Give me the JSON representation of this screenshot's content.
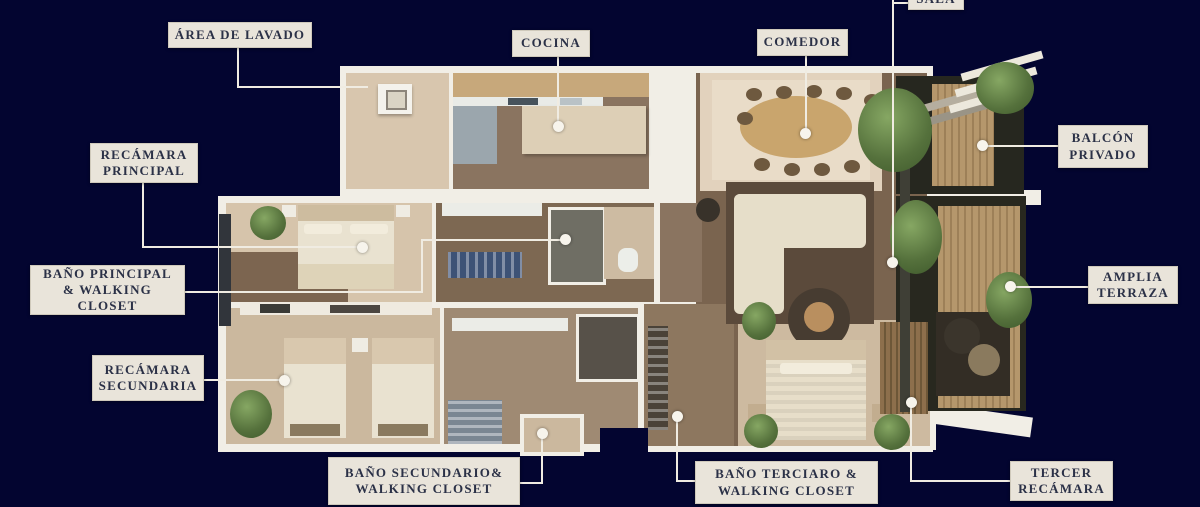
{
  "page": {
    "type": "floor-plan-diagram",
    "background_color": "#030530",
    "label_background": "#e9e4da",
    "label_text_color": "#2b3147",
    "leader_line_color": "#f0ece2"
  },
  "labels": [
    {
      "id": "area-de-lavado",
      "text": "ÁREA DE LAVADO"
    },
    {
      "id": "cocina",
      "text": "COCINA"
    },
    {
      "id": "comedor",
      "text": "COMEDOR"
    },
    {
      "id": "sala",
      "text": "SALA"
    },
    {
      "id": "balcon-privado",
      "text": "BALCÓN\nPRIVADO"
    },
    {
      "id": "recamara-principal",
      "text": "RECÁMARA\nPRINCIPAL"
    },
    {
      "id": "bano-principal",
      "text": "BAÑO PRINCIPAL\n& WALKING\nCLOSET"
    },
    {
      "id": "recamara-secundaria",
      "text": "RECÁMARA\nSECUNDARIA"
    },
    {
      "id": "bano-secundario",
      "text": "BAÑO SECUNDARIO&\nWALKING CLOSET"
    },
    {
      "id": "bano-terciario",
      "text": "BAÑO TERCIARO &\nWALKING CLOSET"
    },
    {
      "id": "tercer-recamara",
      "text": "TERCER\nRECÁMARA"
    },
    {
      "id": "amplia-terraza",
      "text": "AMPLIA\nTERRAZA"
    }
  ]
}
